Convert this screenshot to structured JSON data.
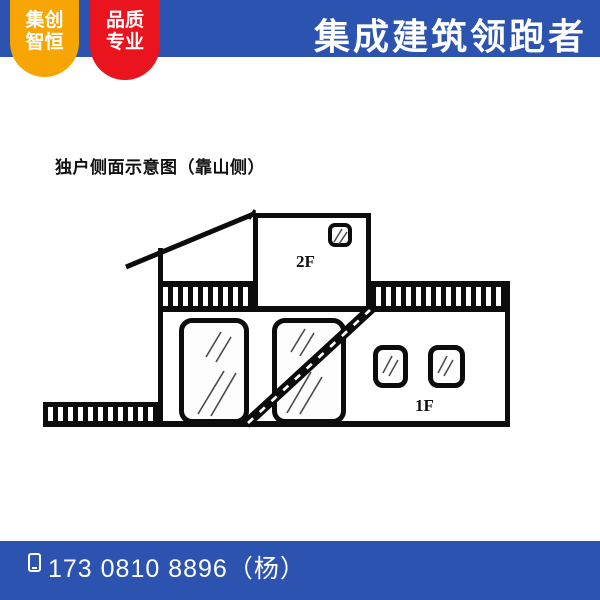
{
  "header": {
    "badge_left": {
      "line1": "集创",
      "line2": "智恒"
    },
    "badge_right": {
      "line1": "品质",
      "line2": "专业"
    },
    "title": "集成建筑领跑者"
  },
  "diagram": {
    "title": "独户侧面示意图（靠山侧）",
    "labels": {
      "floor2": "2F",
      "floor1": "1F"
    }
  },
  "footer": {
    "phone": "173 0810 8896（杨）"
  },
  "colors": {
    "banner_blue": "#2c53b0",
    "badge_orange": "#f6a504",
    "badge_red": "#e9141d",
    "line_black": "#0c0c0c",
    "text_white": "#ffffff"
  }
}
